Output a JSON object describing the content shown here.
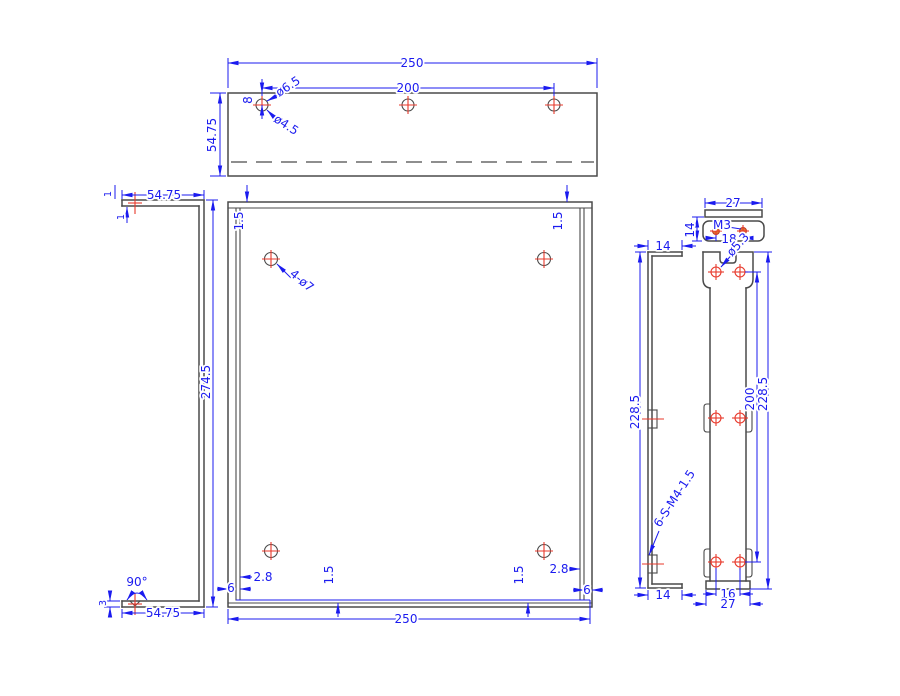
{
  "labels": {
    "top_view": {
      "width": "250",
      "hole_spacing": "200",
      "depth": "54.75",
      "hole_edge_offset": "8",
      "cbore_dia": "ø6.5",
      "hole_dia": "ø4.5"
    },
    "side_view": {
      "flange_width_top": "54.75",
      "thickness_top": "1",
      "thickness_lip": "1",
      "height": "274.5",
      "bend_angle": "90°",
      "hem_height": "3",
      "flange_width_bottom": "54.75"
    },
    "front_view": {
      "offset_top_left": "1.5",
      "offset_top_right": "1.5",
      "corner_holes": "4-ø7",
      "inset_bottom_left": "2.8",
      "edge_bottom_left": "6",
      "bend_offset_left": "1.5",
      "bend_offset_right": "1.5",
      "inset_bottom_right": "2.8",
      "edge_bottom_right": "6",
      "width": "250"
    },
    "flange_detail": {
      "width": "27",
      "depth": "14",
      "thread_callout": "M3",
      "hole_spacing": "18"
    },
    "bracket_side": {
      "flange_top": "14",
      "height": "228.5",
      "standoff_callout": "6-S-M4-1.5",
      "flange_bottom": "14"
    },
    "bracket_front": {
      "hole_dia": "ø5.3",
      "hole_row_span": "200",
      "height": "228.5",
      "hole_spacing": "16",
      "width": "27"
    }
  },
  "colors": {
    "dimension": "#1b1bef",
    "geometry": "#4a4a4a",
    "center_mark": "#e8392b",
    "hole_fill": "#e07b30"
  }
}
